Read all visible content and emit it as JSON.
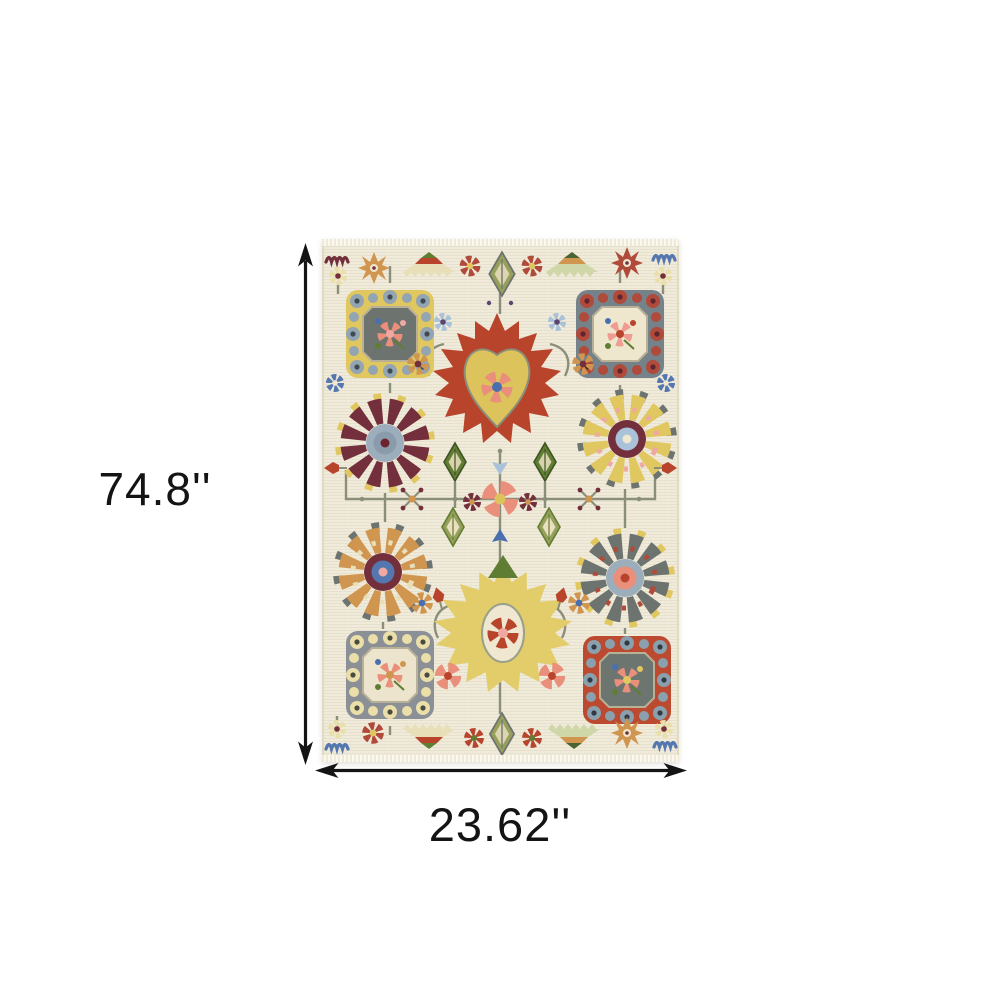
{
  "page": {
    "background_color": "#ffffff"
  },
  "dimensions": {
    "height": {
      "label": "74.8''",
      "orientation": "vertical"
    },
    "width": {
      "label": "23.62''",
      "orientation": "horizontal"
    },
    "arrow_color": "#141414",
    "label_color": "#141414"
  },
  "product": {
    "type": "area-rug",
    "style": "oriental floral medallion with fringe",
    "field_color": "#f0ead9",
    "fringe_color": "#f6f2e6",
    "palette": {
      "rust_red": "#b8442c",
      "deep_red": "#a03a28",
      "maroon": "#73303c",
      "coral": "#e98f7b",
      "pink": "#f0a9a2",
      "gold": "#e0c75f",
      "pale_yellow": "#eadfa9",
      "orange": "#d0954e",
      "slate_gray": "#6d7470",
      "frame_gray": "#76828a",
      "blue_gray": "#93a4b2",
      "light_blue": "#a9c2da",
      "blue": "#4a6fae",
      "green": "#5f7d33",
      "olive": "#97a05a",
      "sage_vine": "#8b8e79",
      "purple": "#5c4470",
      "cream": "#efe7cf"
    },
    "motifs": [
      "scroll-square-medallion-top-left-gold",
      "scroll-square-medallion-top-right-gray-red",
      "scroll-square-medallion-bottom-left-gray-cream",
      "scroll-square-medallion-bottom-right-red",
      "red-palmette-center-top",
      "yellow-palmette-center-bottom",
      "pinwheel-flower-maroon",
      "pinwheel-flower-gold",
      "pinwheel-flower-orange",
      "pinwheel-flower-gray",
      "vine-trellis-network",
      "leaf-diamonds",
      "rosettes-and-tulips",
      "striped-border-leaves",
      "snowflake-rosettes",
      "squiggle-accents"
    ]
  }
}
